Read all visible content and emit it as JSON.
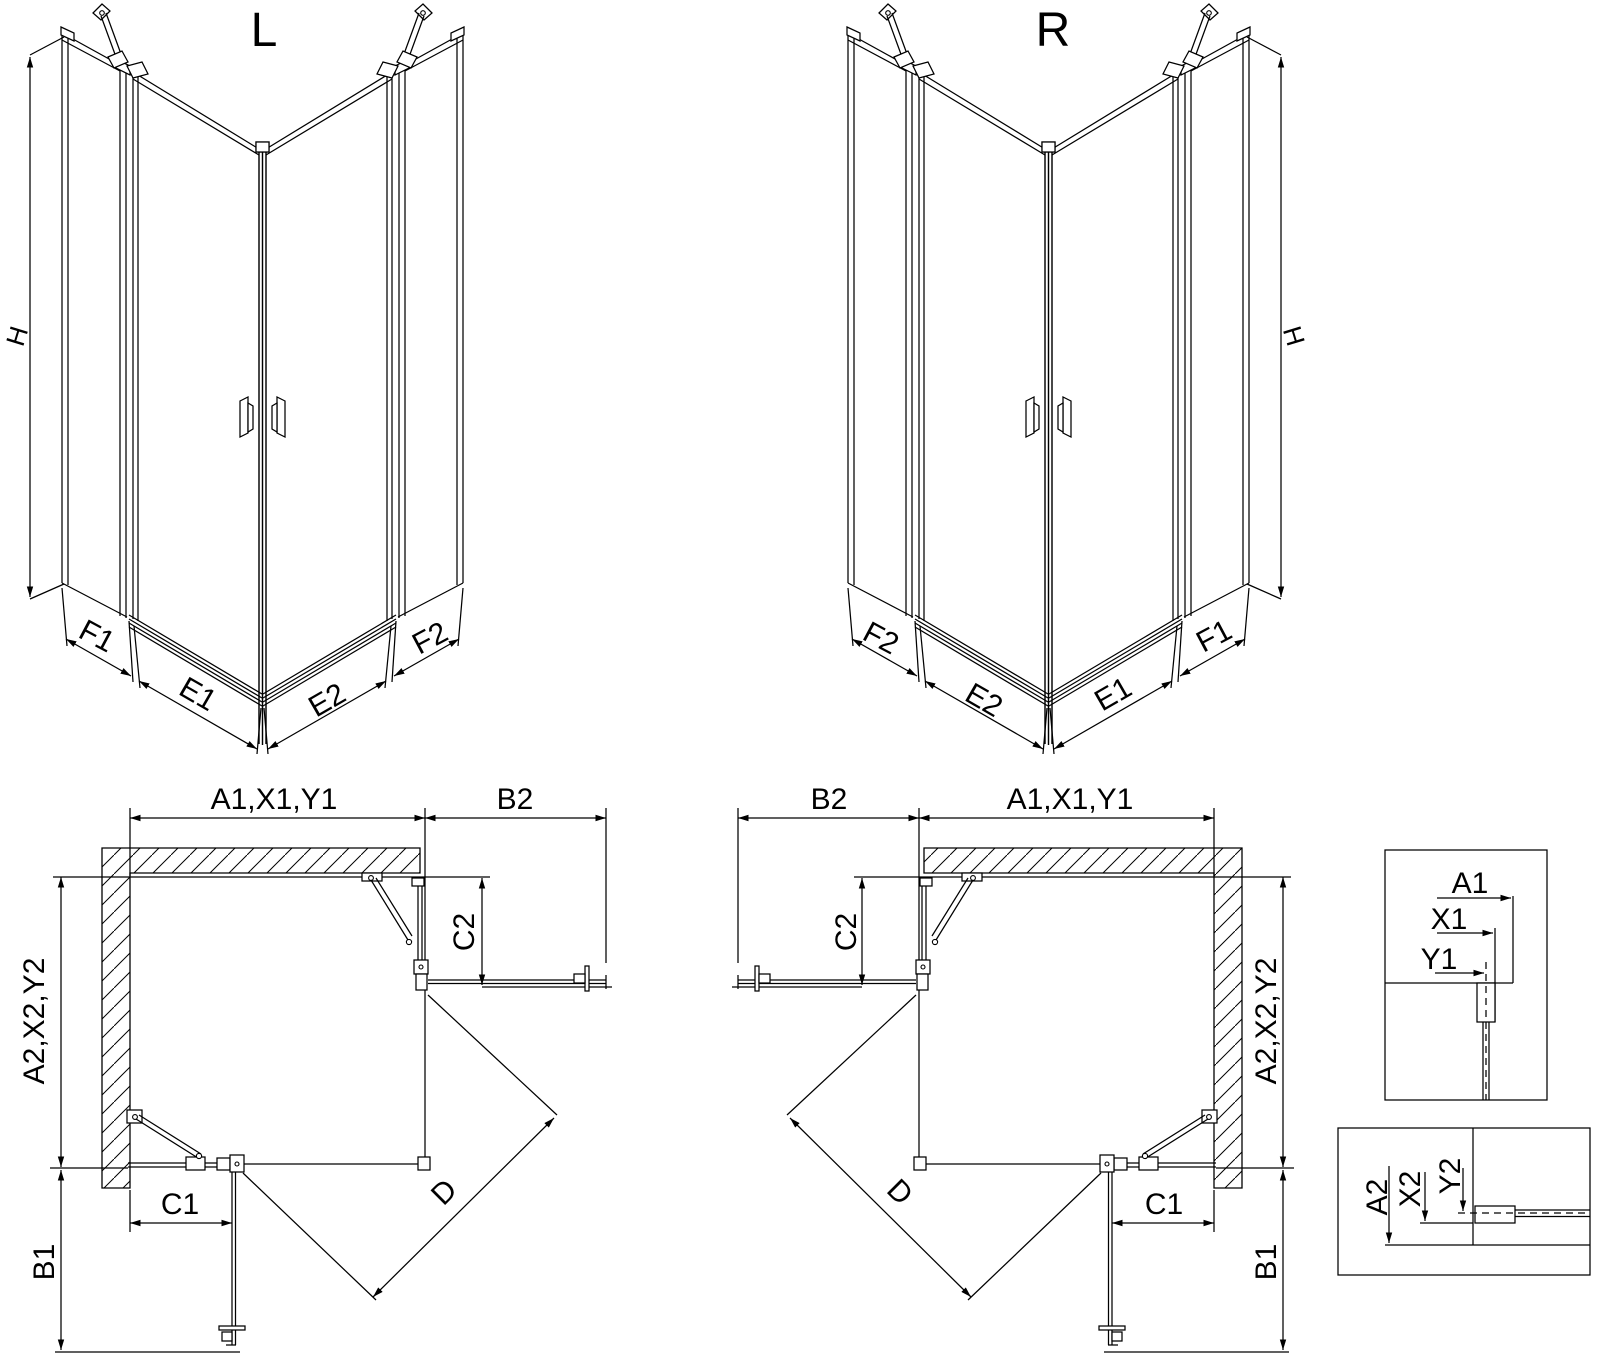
{
  "drawing": {
    "background": "#ffffff",
    "line_color": "#000000",
    "views": {
      "iso_left": {
        "title": "L",
        "dim_height": "H",
        "dim_panel_f1": "F1",
        "dim_door_e1": "E1",
        "dim_door_e2": "E2",
        "dim_panel_f2": "F2"
      },
      "iso_right": {
        "title": "R",
        "dim_height": "H",
        "dim_panel_f2": "F2",
        "dim_door_e2": "E2",
        "dim_door_e1": "E1",
        "dim_panel_f1": "F1"
      },
      "plan_left": {
        "dim_top": "A1,X1,Y1",
        "dim_return_top": "B2",
        "dim_return_fixed": "C2",
        "dim_side": "A2,X2,Y2",
        "dim_front_fixed": "C1",
        "dim_diagonal": "D",
        "dim_front_return": "B1"
      },
      "plan_right": {
        "dim_top": "A1,X1,Y1",
        "dim_return_top": "B2",
        "dim_return_fixed": "C2",
        "dim_side": "A2,X2,Y2",
        "dim_front_fixed": "C1",
        "dim_diagonal": "D",
        "dim_front_return": "B1"
      },
      "detail_wall_top": {
        "dim_a": "A1",
        "dim_x": "X1",
        "dim_y": "Y1"
      },
      "detail_wall_bottom": {
        "dim_a": "A2",
        "dim_x": "X2",
        "dim_y": "Y2"
      }
    }
  }
}
